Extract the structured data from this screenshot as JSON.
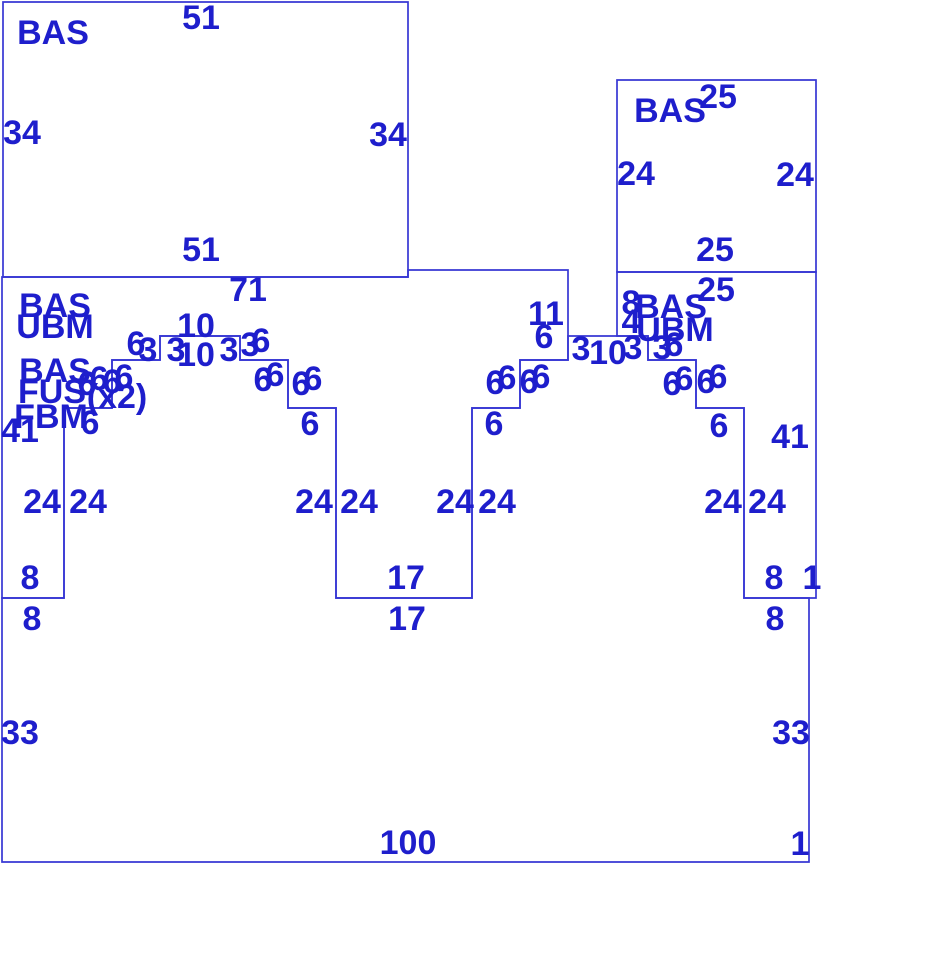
{
  "canvas": {
    "width": 926,
    "height": 974,
    "background": "#ffffff"
  },
  "style": {
    "line_color": "#3737d4",
    "label_color": "#1e1ecc",
    "line_width": 1.7,
    "font_size": 34
  },
  "drawing": {
    "description": "panel-layout-elevation-with-stepped-arch-openings",
    "unit_px": 8,
    "panels": [
      {
        "id": "top-left-panel",
        "type": "BAS",
        "points": [
          [
            3,
            2
          ],
          [
            408,
            2
          ],
          [
            408,
            277
          ],
          [
            3,
            277
          ]
        ]
      },
      {
        "id": "top-right-panel",
        "type": "BAS",
        "points": [
          [
            617,
            80
          ],
          [
            816,
            80
          ],
          [
            816,
            272
          ],
          [
            617,
            272
          ]
        ]
      },
      {
        "id": "left-wall-panel",
        "type": "BAS/UBM",
        "points": [
          [
            2,
            277
          ],
          [
            408,
            277
          ],
          [
            408,
            270
          ],
          [
            568,
            270
          ],
          [
            568,
            360
          ],
          [
            520,
            360
          ],
          [
            520,
            408
          ],
          [
            472,
            408
          ],
          [
            472,
            598
          ],
          [
            336,
            598
          ],
          [
            336,
            408
          ],
          [
            288,
            408
          ],
          [
            288,
            360
          ],
          [
            240,
            360
          ],
          [
            240,
            336
          ],
          [
            160,
            336
          ],
          [
            160,
            360
          ],
          [
            112,
            360
          ],
          [
            112,
            408
          ],
          [
            64,
            408
          ],
          [
            64,
            598
          ],
          [
            2,
            598
          ]
        ]
      },
      {
        "id": "right-wall-panel",
        "type": "BAS/UBM",
        "points": [
          [
            617,
            272
          ],
          [
            816,
            272
          ],
          [
            816,
            598
          ],
          [
            744,
            598
          ],
          [
            744,
            408
          ],
          [
            696,
            408
          ],
          [
            696,
            360
          ],
          [
            648,
            360
          ],
          [
            648,
            336
          ],
          [
            617,
            336
          ]
        ]
      },
      {
        "id": "base-panel",
        "type": "BAS/FUS/FBM",
        "points": [
          [
            2,
            598
          ],
          [
            64,
            598
          ],
          [
            64,
            408
          ],
          [
            112,
            408
          ],
          [
            112,
            360
          ],
          [
            160,
            360
          ],
          [
            160,
            336
          ],
          [
            240,
            336
          ],
          [
            240,
            360
          ],
          [
            288,
            360
          ],
          [
            288,
            408
          ],
          [
            336,
            408
          ],
          [
            336,
            598
          ],
          [
            472,
            598
          ],
          [
            472,
            408
          ],
          [
            520,
            408
          ],
          [
            520,
            360
          ],
          [
            568,
            360
          ],
          [
            568,
            336
          ],
          [
            648,
            336
          ],
          [
            648,
            360
          ],
          [
            696,
            360
          ],
          [
            696,
            408
          ],
          [
            744,
            408
          ],
          [
            744,
            598
          ],
          [
            809,
            598
          ],
          [
            809,
            862
          ],
          [
            2,
            862
          ]
        ]
      }
    ],
    "legend_labels": [
      {
        "t": "BAS",
        "x": 53,
        "y": 33
      },
      {
        "t": "BAS",
        "x": 670,
        "y": 111
      },
      {
        "t": "BAS",
        "x": 55,
        "y": 306
      },
      {
        "t": "UBM",
        "x": 55,
        "y": 327
      },
      {
        "t": "BAS",
        "x": 55,
        "y": 371
      },
      {
        "t": "FUS",
        "x": 52,
        "y": 392
      },
      {
        "t": "(x2)",
        "x": 117,
        "y": 397
      },
      {
        "t": "FBM",
        "x": 51,
        "y": 417
      },
      {
        "t": "BAS",
        "x": 671,
        "y": 307
      },
      {
        "t": "UBM",
        "x": 675,
        "y": 330
      }
    ],
    "dimension_labels": [
      {
        "t": "51",
        "x": 201,
        "y": 18
      },
      {
        "t": "34",
        "x": 22,
        "y": 133
      },
      {
        "t": "34",
        "x": 388,
        "y": 135
      },
      {
        "t": "51",
        "x": 201,
        "y": 250
      },
      {
        "t": "25",
        "x": 718,
        "y": 97
      },
      {
        "t": "24",
        "x": 636,
        "y": 174
      },
      {
        "t": "24",
        "x": 795,
        "y": 175
      },
      {
        "t": "25",
        "x": 715,
        "y": 250
      },
      {
        "t": "71",
        "x": 248,
        "y": 290
      },
      {
        "t": "11",
        "x": 546,
        "y": 314
      },
      {
        "t": "6",
        "x": 544,
        "y": 337
      },
      {
        "t": "41",
        "x": 20,
        "y": 431
      },
      {
        "t": "41",
        "x": 790,
        "y": 437
      },
      {
        "t": "25",
        "x": 716,
        "y": 290
      },
      {
        "t": "8",
        "x": 631,
        "y": 303
      },
      {
        "t": "4",
        "x": 631,
        "y": 322
      },
      {
        "t": "6",
        "x": 87,
        "y": 384
      },
      {
        "t": "6",
        "x": 99,
        "y": 379
      },
      {
        "t": "6",
        "x": 112,
        "y": 382
      },
      {
        "t": "6",
        "x": 124,
        "y": 377
      },
      {
        "t": "6",
        "x": 136,
        "y": 344
      },
      {
        "t": "3",
        "x": 148,
        "y": 350
      },
      {
        "t": "3",
        "x": 176,
        "y": 350
      },
      {
        "t": "10",
        "x": 196,
        "y": 326
      },
      {
        "t": "10",
        "x": 196,
        "y": 355
      },
      {
        "t": "3",
        "x": 229,
        "y": 350
      },
      {
        "t": "3",
        "x": 250,
        "y": 345
      },
      {
        "t": "6",
        "x": 261,
        "y": 341
      },
      {
        "t": "6",
        "x": 263,
        "y": 380
      },
      {
        "t": "6",
        "x": 275,
        "y": 375
      },
      {
        "t": "6",
        "x": 301,
        "y": 384
      },
      {
        "t": "6",
        "x": 313,
        "y": 379
      },
      {
        "t": "6",
        "x": 90,
        "y": 423
      },
      {
        "t": "6",
        "x": 310,
        "y": 424
      },
      {
        "t": "6",
        "x": 495,
        "y": 383
      },
      {
        "t": "6",
        "x": 507,
        "y": 378
      },
      {
        "t": "6",
        "x": 529,
        "y": 382
      },
      {
        "t": "6",
        "x": 541,
        "y": 377
      },
      {
        "t": "6",
        "x": 494,
        "y": 424
      },
      {
        "t": "3",
        "x": 581,
        "y": 349
      },
      {
        "t": "10",
        "x": 608,
        "y": 353
      },
      {
        "t": "3",
        "x": 633,
        "y": 348
      },
      {
        "t": "3",
        "x": 662,
        "y": 348
      },
      {
        "t": "6",
        "x": 674,
        "y": 345
      },
      {
        "t": "6",
        "x": 672,
        "y": 384
      },
      {
        "t": "6",
        "x": 684,
        "y": 379
      },
      {
        "t": "6",
        "x": 706,
        "y": 382
      },
      {
        "t": "6",
        "x": 718,
        "y": 377
      },
      {
        "t": "6",
        "x": 719,
        "y": 426
      },
      {
        "t": "24",
        "x": 42,
        "y": 502
      },
      {
        "t": "24",
        "x": 88,
        "y": 502
      },
      {
        "t": "24",
        "x": 314,
        "y": 502
      },
      {
        "t": "24",
        "x": 359,
        "y": 502
      },
      {
        "t": "24",
        "x": 455,
        "y": 502
      },
      {
        "t": "24",
        "x": 497,
        "y": 502
      },
      {
        "t": "24",
        "x": 723,
        "y": 502
      },
      {
        "t": "24",
        "x": 767,
        "y": 502
      },
      {
        "t": "8",
        "x": 30,
        "y": 578
      },
      {
        "t": "8",
        "x": 32,
        "y": 619
      },
      {
        "t": "17",
        "x": 406,
        "y": 578
      },
      {
        "t": "17",
        "x": 407,
        "y": 619
      },
      {
        "t": "8",
        "x": 774,
        "y": 578
      },
      {
        "t": "1",
        "x": 812,
        "y": 578
      },
      {
        "t": "8",
        "x": 775,
        "y": 619
      },
      {
        "t": "33",
        "x": 20,
        "y": 733
      },
      {
        "t": "33",
        "x": 791,
        "y": 733
      },
      {
        "t": "100",
        "x": 408,
        "y": 843
      },
      {
        "t": "1",
        "x": 800,
        "y": 844
      }
    ]
  }
}
